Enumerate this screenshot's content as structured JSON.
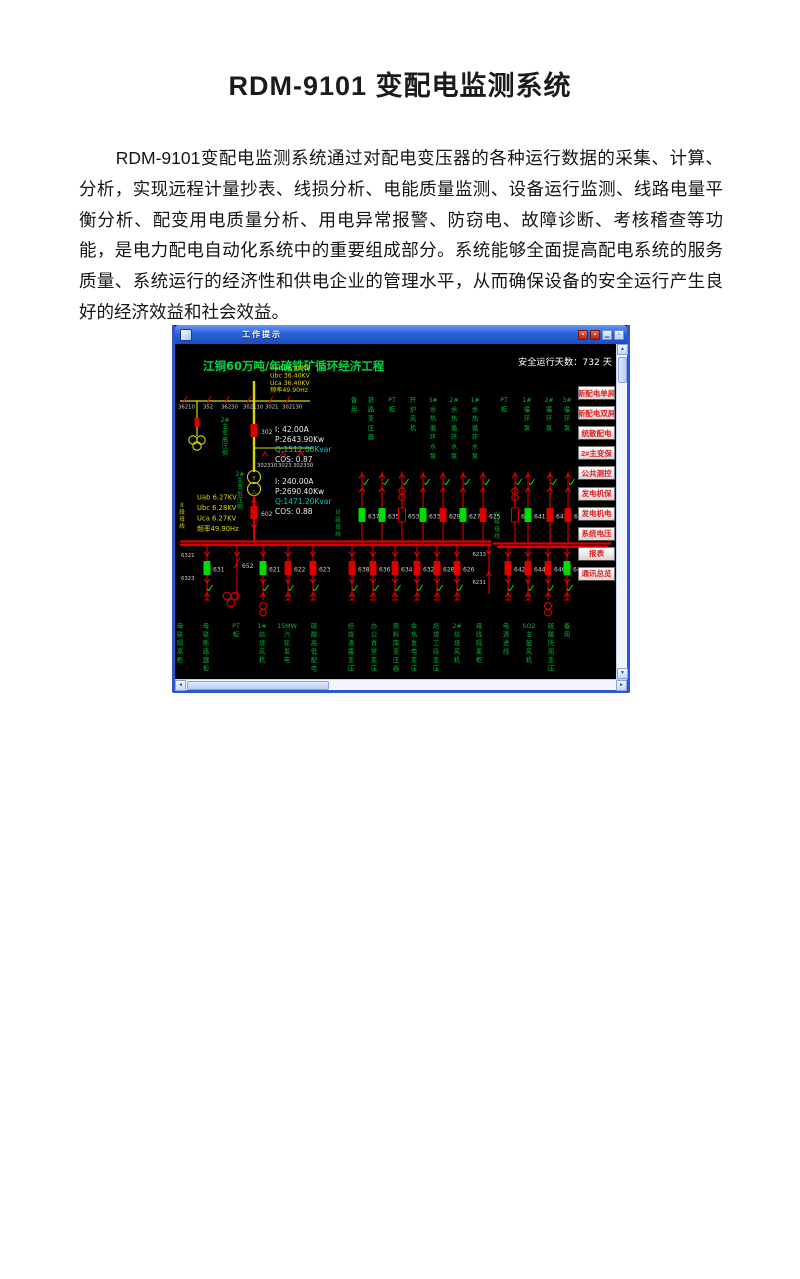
{
  "document": {
    "heading": "RDM-9101 变配电监测系统",
    "body_text": "RDM-9101变配电监测系统通过对配电变压器的各种运行数据的采集、计算、分析，实现远程计量抄表、线损分析、电能质量监测、设备运行监测、线路电量平衡分析、配变用电质量分析、用电异常报警、防窃电、故障诊断、考核稽查等功能，是电力配电自动化系统中的重要组成部分。系统能够全面提高配电系统的服务质量、系统运行的经济性和供电企业的管理水平，从而确保设备的安全运行产生良好的经济效益和社会效益。"
  },
  "window": {
    "titlebar": {
      "title": "工作提示"
    },
    "screen_title": "江铜60万吨/年硫铁矿循环经济工程",
    "safe_days_label": "安全运行天数：",
    "safe_days_value": "732",
    "safe_days_unit": "天"
  },
  "colors": {
    "title_green": "#00d643",
    "green": "#00b434",
    "bright_green": "#00dd00",
    "red": "#dd0000",
    "yellow": "#d8d800",
    "cyan": "#00c8c8",
    "white": "#d0d0d0",
    "menu_text": "#e02020"
  },
  "hv": {
    "voltages": [
      "Uab 36.40KV",
      "Ubc 36.40KV",
      "Uca 36.40KV",
      "频率49.90Hz"
    ],
    "meas": [
      "I:  42.00A",
      "P:2643.90Kw",
      "Q:1512.00Kvar",
      "COS:  0.87"
    ],
    "top_numbers": [
      "36210",
      "352",
      "36230",
      "302110",
      "3021",
      "302130"
    ],
    "mid_numbers": [
      "302310",
      "3023",
      "302330"
    ],
    "breaker_302": "302",
    "incomer_602": "602",
    "label_hv_side": "2#主变高压侧",
    "label_lv_side": "2#主变低压侧"
  },
  "lv": {
    "voltages": [
      "Uab 6.27KV",
      "Ubc 6.28KV",
      "Uca 6.27KV",
      "频率49.90Hz"
    ],
    "meas": [
      "I: 240.00A",
      "P:2690.40Kw",
      "Q:1471.20Kvar",
      "COS:  0.88"
    ]
  },
  "bus": {
    "section_ii": "II段母线",
    "section_iii": "III段母线",
    "section_iv": "IV段母线",
    "left_numbers": [
      "6321",
      "6323"
    ],
    "right_numbers": [
      "6233",
      "6231"
    ]
  },
  "top_feeders": {
    "labels": [
      "备用",
      "铁路变压器",
      "PT柜",
      "开炉风机",
      "3#余热循环水泵",
      "2#余热循环水泵",
      "1#余热循环水泵",
      "PT柜",
      "1#循环泵",
      "2#循环泵",
      "3#循环泵"
    ],
    "breakers": [
      {
        "num": "637",
        "state": "green"
      },
      {
        "num": "635",
        "state": "green"
      },
      {
        "num": "653",
        "state": "fuse"
      },
      {
        "num": "633",
        "state": "green"
      },
      {
        "num": "629",
        "state": "red"
      },
      {
        "num": "627",
        "state": "green"
      },
      {
        "num": "625",
        "state": "red"
      },
      {
        "num": "654",
        "state": "fuse"
      },
      {
        "num": "641",
        "state": "green"
      },
      {
        "num": "643",
        "state": "red"
      },
      {
        "num": "645",
        "state": "red"
      }
    ]
  },
  "bottom_feeders": {
    "breakers": [
      {
        "num": "631",
        "state": "green"
      },
      {
        "num": "652",
        "state": "tie"
      },
      {
        "num": "621",
        "state": "green"
      },
      {
        "num": "622",
        "state": "red"
      },
      {
        "num": "623",
        "state": "red"
      },
      {
        "num": "638",
        "state": "red"
      },
      {
        "num": "636",
        "state": "red"
      },
      {
        "num": "634",
        "state": "red"
      },
      {
        "num": "632",
        "state": "red"
      },
      {
        "num": "628",
        "state": "red"
      },
      {
        "num": "626",
        "state": "red"
      },
      {
        "num": "642",
        "state": "red"
      },
      {
        "num": "644",
        "state": "red"
      },
      {
        "num": "646",
        "state": "red"
      },
      {
        "num": "648",
        "state": "green"
      }
    ],
    "labels": [
      "母联隔离柜",
      "母联断路器柜",
      "PT柜",
      "1#焙烧风机",
      "15MW汽轮发电",
      "硫酸高低配电",
      "焙烧渣露变压",
      "办公食堂变压",
      "原料库变压器",
      "余热发电变压",
      "焙烧工段变压",
      "2#焙烧风机",
      "母线隔离柜",
      "电源进线",
      "SO2主鼓风机",
      "硫酸所用变压",
      "备用"
    ]
  },
  "menu": {
    "buttons": [
      "新配电单屏",
      "新配电双屏",
      "统散配电",
      "2#主变保",
      "公共测控",
      "发电机保",
      "发电机电",
      "系统电压",
      "报表",
      "通讯总览"
    ]
  }
}
